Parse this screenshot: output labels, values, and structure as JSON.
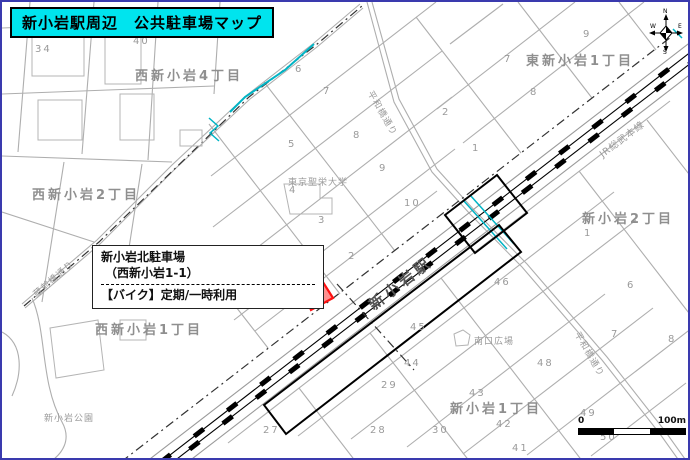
{
  "title": "新小岩駅周辺　公共駐車場マップ",
  "callout": {
    "name_line": "新小岩北駐車場",
    "address_line": "（西新小岩1-1）",
    "usage_line": "【バイク】定期/一時利用"
  },
  "compass": {
    "n": "N",
    "e": "E",
    "s": "S",
    "w": "W"
  },
  "scale": {
    "start": "0",
    "end": "100m"
  },
  "colors": {
    "highlight_fill": "#ff9090",
    "highlight_stroke": "#ff1111",
    "water": "#00b4c5",
    "title_bg": "#00e4ee"
  },
  "labels": {
    "districts": [
      {
        "t": "西新小岩4丁目",
        "x": 133,
        "y": 63
      },
      {
        "t": "東新小岩1丁目",
        "x": 524,
        "y": 48
      },
      {
        "t": "西新小岩2丁目",
        "x": 30,
        "y": 182
      },
      {
        "t": "新小岩2丁目",
        "x": 580,
        "y": 206
      },
      {
        "t": "西新小岩1丁目",
        "x": 93,
        "y": 317
      },
      {
        "t": "新小岩1丁目",
        "x": 448,
        "y": 396
      }
    ],
    "places": [
      {
        "t": "東京聖栄大学",
        "x": 286,
        "y": 173
      },
      {
        "t": "南口広場",
        "x": 472,
        "y": 332
      },
      {
        "t": "新小岩公園",
        "x": 42,
        "y": 409
      }
    ],
    "station": [
      {
        "t": "新小岩駅",
        "x": 362,
        "y": 296,
        "r": -38
      }
    ],
    "railway": [
      {
        "t": "JR総武本線",
        "x": 594,
        "y": 147,
        "r": -37
      }
    ],
    "roads": [
      {
        "t": "平和橋通り",
        "x": 374,
        "y": 86,
        "r": 60
      },
      {
        "t": "平和橋通り",
        "x": 581,
        "y": 327,
        "r": 60
      },
      {
        "t": "蔵前橋通り",
        "x": 28,
        "y": 288,
        "r": -41
      }
    ],
    "blocks": [
      {
        "t": "34",
        "x": 33,
        "y": 42
      },
      {
        "t": "40",
        "x": 131,
        "y": 34
      },
      {
        "t": "41",
        "x": 196,
        "y": 26
      },
      {
        "t": "42",
        "x": 254,
        "y": 8
      },
      {
        "t": "6",
        "x": 293,
        "y": 62
      },
      {
        "t": "7",
        "x": 321,
        "y": 84
      },
      {
        "t": "5",
        "x": 286,
        "y": 137
      },
      {
        "t": "8",
        "x": 351,
        "y": 128
      },
      {
        "t": "9",
        "x": 377,
        "y": 161
      },
      {
        "t": "4",
        "x": 287,
        "y": 183
      },
      {
        "t": "3",
        "x": 316,
        "y": 213
      },
      {
        "t": "10",
        "x": 402,
        "y": 196
      },
      {
        "t": "2",
        "x": 346,
        "y": 249
      },
      {
        "t": "2",
        "x": 440,
        "y": 105
      },
      {
        "t": "1",
        "x": 470,
        "y": 141
      },
      {
        "t": "7",
        "x": 502,
        "y": 52
      },
      {
        "t": "8",
        "x": 528,
        "y": 85
      },
      {
        "t": "9",
        "x": 581,
        "y": 27
      },
      {
        "t": "1",
        "x": 582,
        "y": 226
      },
      {
        "t": "6",
        "x": 625,
        "y": 278
      },
      {
        "t": "7",
        "x": 609,
        "y": 327
      },
      {
        "t": "8",
        "x": 666,
        "y": 332
      },
      {
        "t": "46",
        "x": 492,
        "y": 275
      },
      {
        "t": "45",
        "x": 408,
        "y": 320
      },
      {
        "t": "44",
        "x": 402,
        "y": 356
      },
      {
        "t": "29",
        "x": 379,
        "y": 378
      },
      {
        "t": "28",
        "x": 368,
        "y": 423
      },
      {
        "t": "30",
        "x": 430,
        "y": 423
      },
      {
        "t": "27",
        "x": 261,
        "y": 423
      },
      {
        "t": "48",
        "x": 535,
        "y": 356
      },
      {
        "t": "43",
        "x": 467,
        "y": 386
      },
      {
        "t": "42",
        "x": 494,
        "y": 417
      },
      {
        "t": "49",
        "x": 578,
        "y": 406
      },
      {
        "t": "50",
        "x": 598,
        "y": 430
      },
      {
        "t": "41",
        "x": 510,
        "y": 441
      }
    ]
  }
}
